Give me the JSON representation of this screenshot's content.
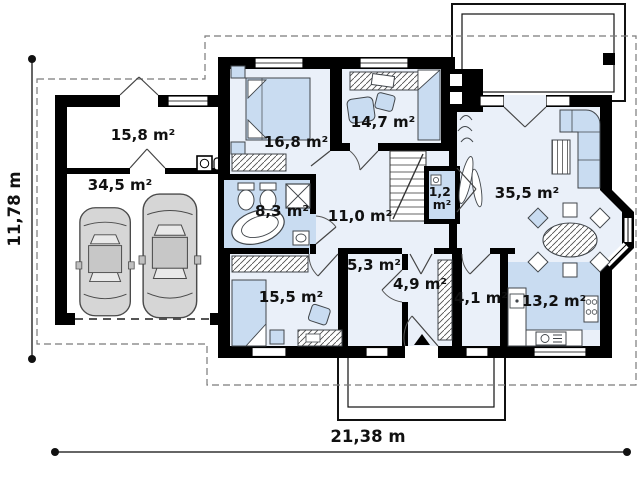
{
  "plan": {
    "dimensions": {
      "side": "11,78 m",
      "front": "21,38 m"
    },
    "rooms": [
      {
        "name": "utility-room",
        "area": "15,8 m²"
      },
      {
        "name": "garage",
        "area": "34,5 m²"
      },
      {
        "name": "bedroom-1",
        "area": "16,8 m²"
      },
      {
        "name": "bedroom-2",
        "area": "14,7 m²"
      },
      {
        "name": "bathroom",
        "area": "8,3 m²"
      },
      {
        "name": "hallway",
        "area": "11,0 m²"
      },
      {
        "name": "wc",
        "area": "1,2 m²",
        "lines": [
          "1,2",
          "m²"
        ]
      },
      {
        "name": "living-room",
        "area": "35,5 m²"
      },
      {
        "name": "storage",
        "area": "5,3 m²"
      },
      {
        "name": "entry-hall",
        "area": "4,9 m²"
      },
      {
        "name": "pantry",
        "area": "4,1 m²"
      },
      {
        "name": "kitchen",
        "area": "13,2 m²"
      },
      {
        "name": "bedroom-3",
        "area": "15,5 m²"
      }
    ],
    "colors": {
      "wall": "#000000",
      "floor": "#eaf0f9",
      "wet_zone": "#c9dcf1",
      "furniture": "#c9dcf1",
      "car": "#d6d6d6",
      "roof_outline": "#7a7a7a"
    }
  }
}
